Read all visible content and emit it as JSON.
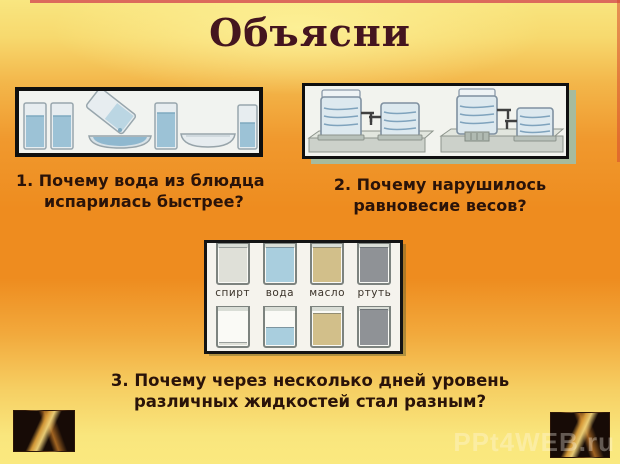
{
  "title": "Объясни",
  "questions": {
    "q1": {
      "line1": "1. Почему вода из блюдца",
      "line2": "испарилась быстрее?"
    },
    "q2": {
      "line1": "2. Почему нарушилось",
      "line2": "равновесие весов?"
    },
    "q3": {
      "line1": "3. Почему через несколько дней уровень",
      "line2": "различных жидкостей стал разным?"
    }
  },
  "liquids_panel": {
    "labels": [
      "спирт",
      "вода",
      "масло",
      "ртуть"
    ],
    "colors": [
      "#dfe0d8",
      "#a9cede",
      "#d2bf8a",
      "#8f9296"
    ],
    "top_levels": [
      0.9,
      0.9,
      0.9,
      0.9
    ],
    "bottom_levels": [
      0.05,
      0.45,
      0.82,
      0.93
    ]
  },
  "watermark": "PPt4WEB.ru",
  "palette": {
    "background_yellow": "#f9e680",
    "background_orange": "#ee8c1f",
    "title_color": "#44151f",
    "question_color": "#2a1309",
    "frame_black": "#111111",
    "frame_sage": "#a6bb9e",
    "top_strip_red": "#dc6a5c"
  }
}
